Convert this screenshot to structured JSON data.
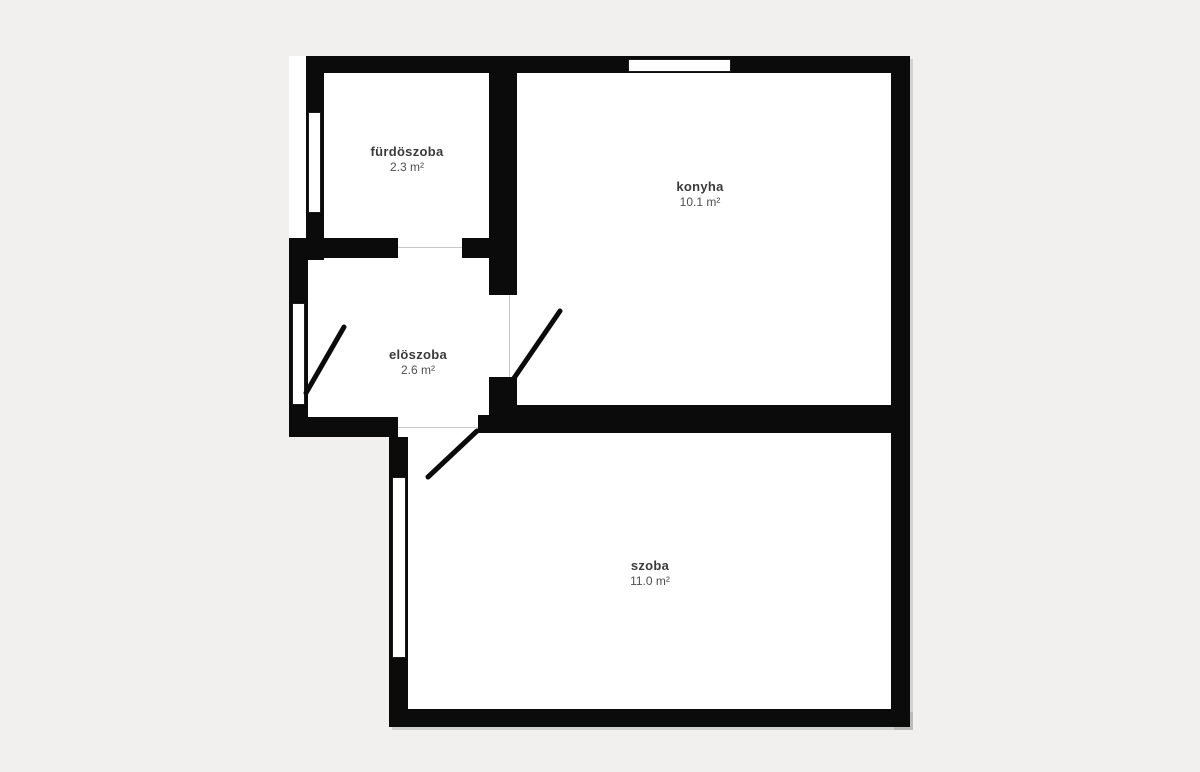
{
  "type": "apartment-floor-plan",
  "rooms": [
    {
      "name": "fürdöszoba",
      "area": "2.3 m²"
    },
    {
      "name": "konyha",
      "area": "10.1 m²"
    },
    {
      "name": "elöszoba",
      "area": "2.6 m²"
    },
    {
      "name": "szoba",
      "area": "11.0 m²"
    }
  ],
  "colors": {
    "background": "#f1f0ee",
    "wall": "#0b0b0b",
    "floor": "#ffffff",
    "opening_line": "#c9c9c9",
    "label_name": "#3b3b3b",
    "label_area": "#4f4f4f"
  }
}
